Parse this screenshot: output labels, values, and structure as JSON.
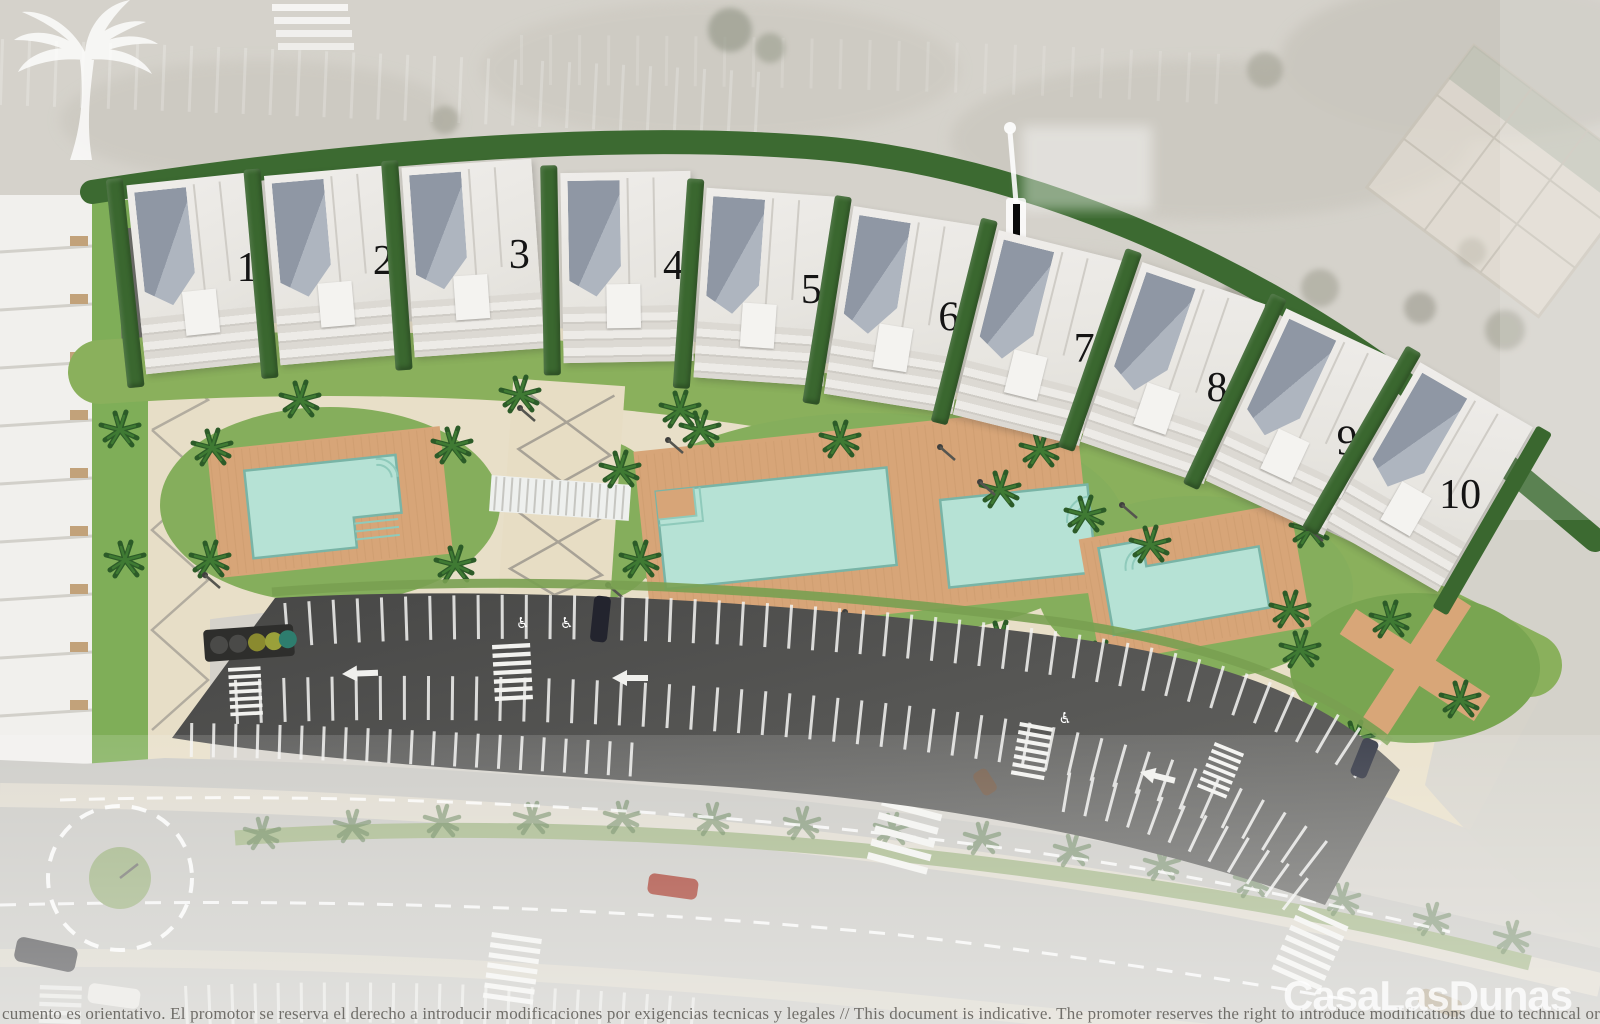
{
  "buildings": [
    {
      "label": "1"
    },
    {
      "label": "2"
    },
    {
      "label": "3"
    },
    {
      "label": "4"
    },
    {
      "label": "5"
    },
    {
      "label": "6"
    },
    {
      "label": "7"
    },
    {
      "label": "8"
    },
    {
      "label": "9"
    },
    {
      "label": "10"
    }
  ],
  "footer": {
    "disclaimer": "cumento es orientativo. El promotor se reserva el derecho a introducir modificaciones por exigencias tecnicas y legales // This document is indicative. The promoter reserves the right to introduce modifications due to technical or legal"
  },
  "brand": {
    "name": "CasaLasDunas",
    "logo_icon": "palm-tree-logo-icon"
  },
  "icons": {
    "accessible": "♿"
  },
  "colors": {
    "pool_water": "#b6e2d5",
    "deck_wood": "#d7a578",
    "lawn": "#85ae5c",
    "hedge": "#3a672f",
    "asphalt": "#4e4e4c",
    "sand": "#d5d2cb",
    "promenade": "#e8dfc8",
    "marking_white": "#f4f4f2"
  }
}
